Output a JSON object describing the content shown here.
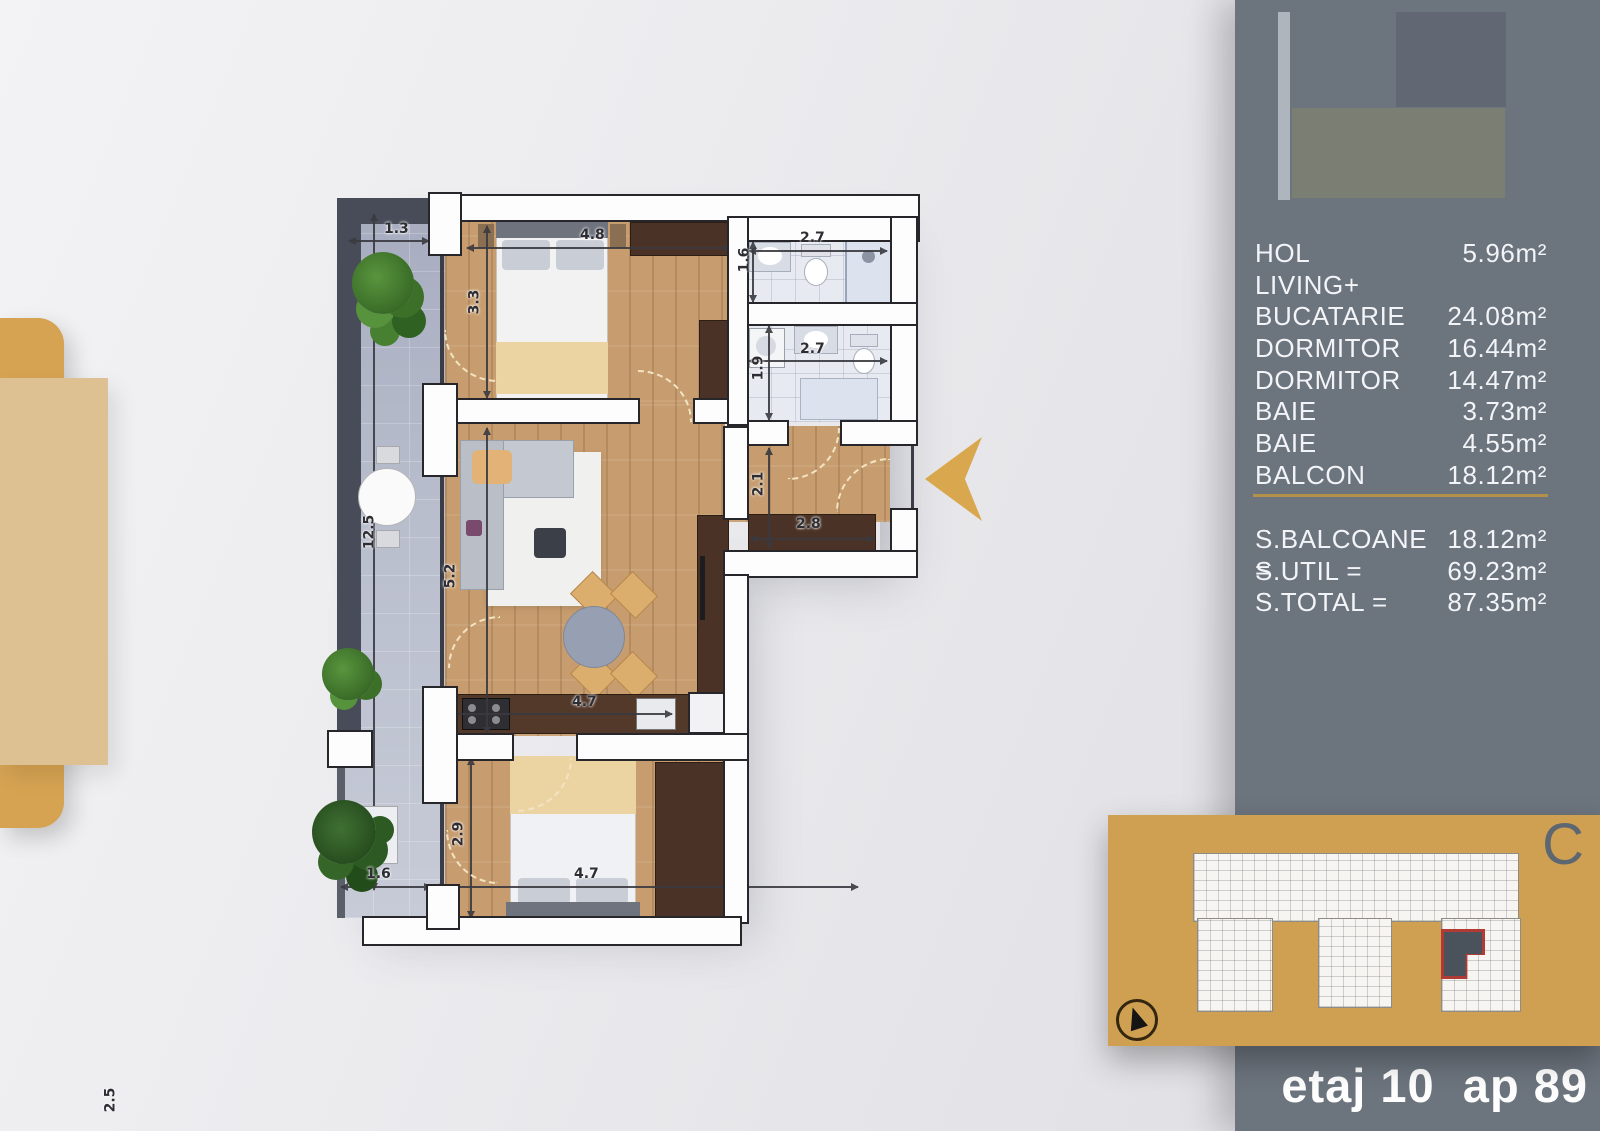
{
  "legend": {
    "rooms": [
      {
        "label": "HOL",
        "value": "5.96m²"
      },
      {
        "label": "LIVING+",
        "value": ""
      },
      {
        "label": "BUCATARIE",
        "value": "24.08m²"
      },
      {
        "label": "DORMITOR",
        "value": "16.44m²"
      },
      {
        "label": "DORMITOR",
        "value": "14.47m²"
      },
      {
        "label": "BAIE",
        "value": "3.73m²"
      },
      {
        "label": "BAIE",
        "value": "4.55m²"
      },
      {
        "label": "BALCON",
        "value": "18.12m²"
      }
    ],
    "totals": [
      {
        "label": "S.BALCOANE =",
        "value": "18.12m²"
      },
      {
        "label": "S.UTIL =",
        "value": "69.23m²"
      },
      {
        "label": "S.TOTAL =",
        "value": "87.35m²"
      }
    ]
  },
  "footer": {
    "text": "etaj 10  ap 89"
  },
  "site_panel": {
    "letter": "C"
  },
  "accent_colors": {
    "gold": "#cfa052",
    "sidebar_gray": "#6c747e",
    "highlight_red": "#b23a35"
  },
  "plan": {
    "dim_labels": [
      {
        "t": "1.3",
        "x": 384,
        "y": 221,
        "r": 0
      },
      {
        "t": "12.5",
        "x": 352,
        "y": 524,
        "r": -90
      },
      {
        "t": "3.3",
        "x": 462,
        "y": 294,
        "r": -90
      },
      {
        "t": "4.8",
        "x": 580,
        "y": 227,
        "r": 0
      },
      {
        "t": "2.7",
        "x": 800,
        "y": 230,
        "r": 0
      },
      {
        "t": "1.6",
        "x": 732,
        "y": 252,
        "r": -90
      },
      {
        "t": "2.7",
        "x": 800,
        "y": 341,
        "r": 0
      },
      {
        "t": "1.9",
        "x": 746,
        "y": 360,
        "r": -90
      },
      {
        "t": "2.1",
        "x": 746,
        "y": 476,
        "r": -90
      },
      {
        "t": "2.8",
        "x": 796,
        "y": 516,
        "r": 0
      },
      {
        "t": "5.2",
        "x": 438,
        "y": 568,
        "r": -90
      },
      {
        "t": "4.7",
        "x": 572,
        "y": 694,
        "r": 0
      },
      {
        "t": "2.9",
        "x": 446,
        "y": 826,
        "r": -90
      },
      {
        "t": "1.6",
        "x": 366,
        "y": 866,
        "r": 0
      },
      {
        "t": "4.7",
        "x": 574,
        "y": 866,
        "r": 0
      },
      {
        "t": "2.5",
        "x": 98,
        "y": 1092,
        "r": -90
      }
    ]
  }
}
